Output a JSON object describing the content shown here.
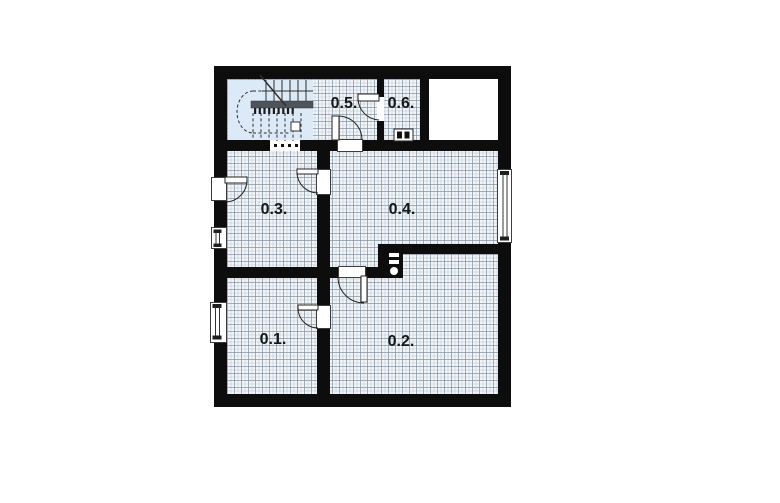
{
  "plan": {
    "type": "floor-plan",
    "rooms": [
      {
        "id": "room-0-1",
        "label": "0.1."
      },
      {
        "id": "room-0-2",
        "label": "0.2."
      },
      {
        "id": "room-0-3",
        "label": "0.3."
      },
      {
        "id": "room-0-4",
        "label": "0.4."
      },
      {
        "id": "room-0-5",
        "label": "0.5."
      },
      {
        "id": "room-0-6",
        "label": "0.6."
      }
    ],
    "colors": {
      "wall": "#0d0d0d",
      "tile_fill": "#f1f5f8",
      "tile_line": "#7d8e9e",
      "stairwell_fill": "#dce9f7",
      "background": "#ffffff"
    }
  }
}
